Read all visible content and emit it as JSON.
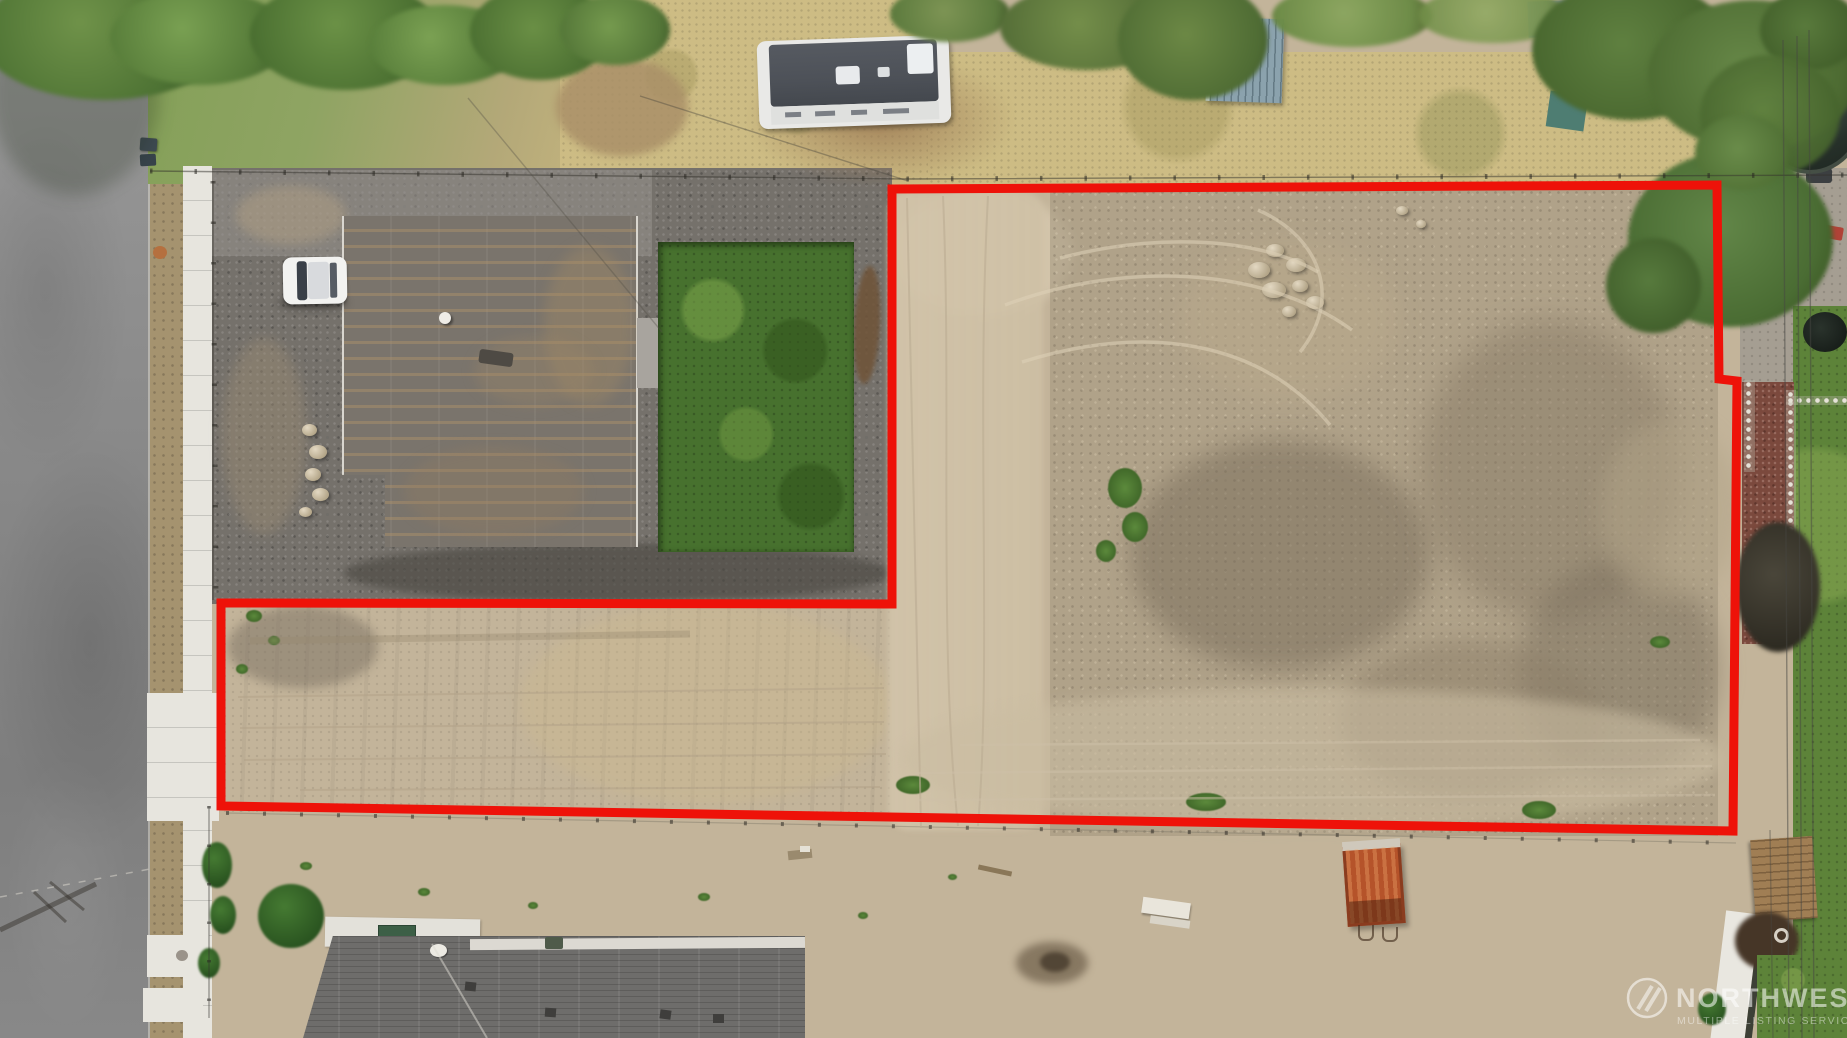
{
  "image": {
    "kind": "aerial-drone-photo",
    "subject": "vacant residential land parcel outlined in red (flag/L-shaped lot) beside existing homes, street, RV and dirt field",
    "width": 1847,
    "height": 1038
  },
  "boundary": {
    "color": "#ee1209",
    "stroke_width": 9,
    "shape": "L-shaped lot outline",
    "vertices": [
      [
        892,
        189
      ],
      [
        1717,
        185
      ],
      [
        1719,
        379
      ],
      [
        1737,
        381
      ],
      [
        1733,
        831
      ],
      [
        221,
        806
      ],
      [
        221,
        603
      ],
      [
        892,
        604
      ]
    ]
  },
  "watermark": {
    "line1": "NORTHWEST",
    "line2": "MULTIPLE LISTING SERVICE",
    "logo": "nwmls-circle-logo"
  },
  "colors": {
    "boundary-red": "#ee1209",
    "road-gray": "#8e8e8e",
    "concrete": "#e7e5de",
    "gravel-dark": "#75716b",
    "roof-gray": "#7a746c",
    "lawn-green": "#47712e",
    "dirt-light": "#c3b49a",
    "dirt-rough": "#a3957f",
    "dry-grass": "#cdbc84",
    "tree-green": "#547939",
    "mulch-red": "#7b493d",
    "dumpster-orange": "#b5532a",
    "rv-roof": "#4d5158",
    "watermark-white": "rgba(255,255,255,0.55)"
  },
  "scene_features": [
    "asphalt-street-left",
    "concrete-sidewalk",
    "gravel-yard",
    "flat-roof-house",
    "green-lawn",
    "white-car",
    "travel-trailer-rv",
    "garden-shed",
    "trampoline",
    "graded-dirt-parcel",
    "tire-tracks",
    "rock-pile",
    "orange-dump-trailer",
    "bottom-house-shingle-roof",
    "power-lines",
    "chain-link-fence",
    "red-lot-outline",
    "mls-watermark"
  ]
}
